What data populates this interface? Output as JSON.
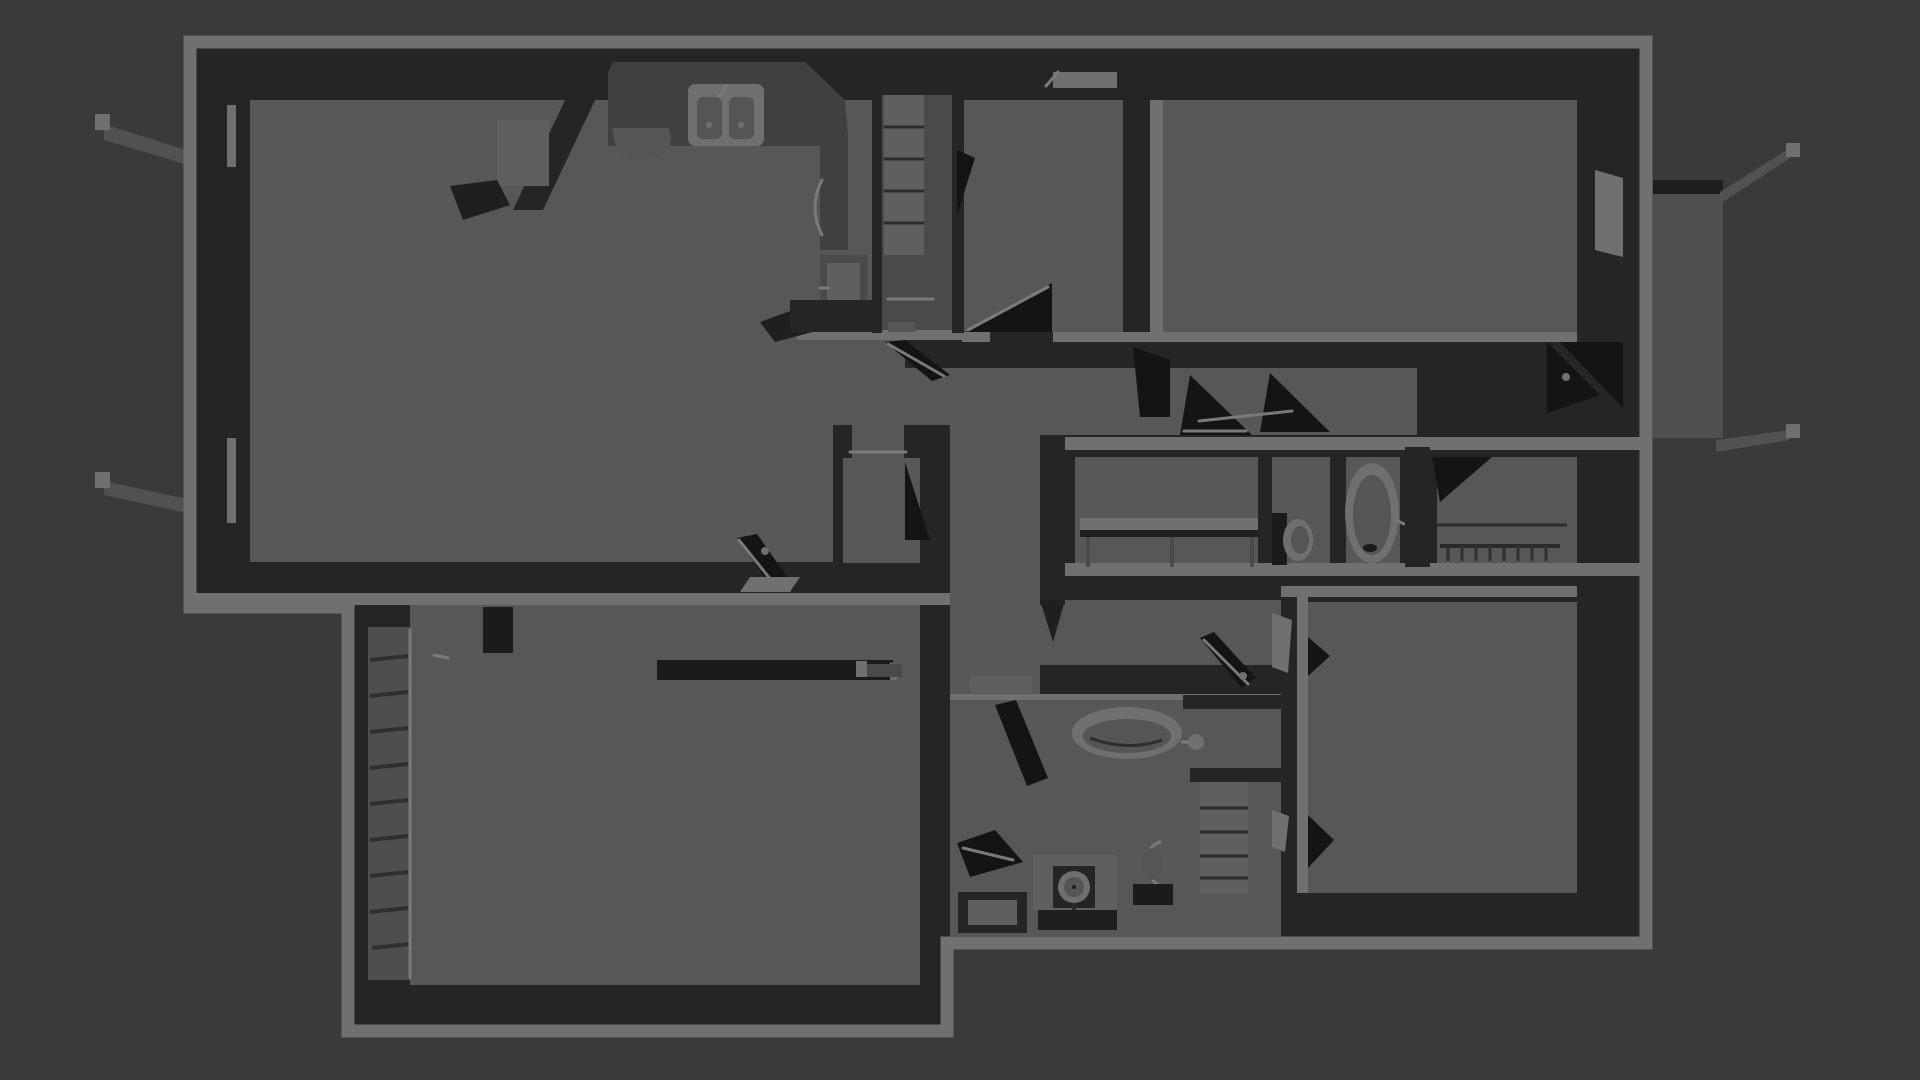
{
  "scene": {
    "kind": "3d-floorplan-render",
    "view": "top-down",
    "lighting": "dimmed",
    "width_px": 1920,
    "height_px": 1080
  },
  "colors": {
    "background": "#3a3a3a",
    "wall_face": "#252525",
    "wall_top": "#707070",
    "floor": "#575757",
    "fixture_dark": "#1b1b1b",
    "fixture_mid": "#4a4a4a",
    "counter": "#404040",
    "porcelain": "#6f6f6f",
    "porch": "#4f4f4f",
    "louver_panel": "#4e4e4e",
    "highlight": "#7a7a7a"
  },
  "rooms": [
    {
      "id": "living-room"
    },
    {
      "id": "kitchen"
    },
    {
      "id": "pantry-closet"
    },
    {
      "id": "bedroom-2"
    },
    {
      "id": "bedroom-3"
    },
    {
      "id": "upper-hallway"
    },
    {
      "id": "center-closet"
    },
    {
      "id": "hall-bathroom"
    },
    {
      "id": "east-closet"
    },
    {
      "id": "entry"
    },
    {
      "id": "corridor"
    },
    {
      "id": "master-bathroom"
    },
    {
      "id": "master-bedroom"
    },
    {
      "id": "garage"
    }
  ],
  "fixtures": [
    {
      "id": "kitchen-counter"
    },
    {
      "id": "kitchen-double-sink"
    },
    {
      "id": "dishwasher-arc"
    },
    {
      "id": "oven-range"
    },
    {
      "id": "corner-fireplace"
    },
    {
      "id": "pantry-shelves"
    },
    {
      "id": "vanity-console"
    },
    {
      "id": "hall-toilet"
    },
    {
      "id": "hall-bathtub"
    },
    {
      "id": "closet-rod-hangers"
    },
    {
      "id": "garden-tub"
    },
    {
      "id": "tub-faucet"
    },
    {
      "id": "round-sink-vanity"
    },
    {
      "id": "master-toilet"
    },
    {
      "id": "linen-shelves"
    },
    {
      "id": "shower-stall"
    },
    {
      "id": "garage-workbench"
    },
    {
      "id": "louvered-door"
    },
    {
      "id": "water-heater"
    },
    {
      "id": "window-sill-west-1"
    },
    {
      "id": "window-sill-west-2"
    },
    {
      "id": "porch-slab"
    },
    {
      "id": "porch-posts"
    },
    {
      "id": "open-door-leaves"
    }
  ]
}
